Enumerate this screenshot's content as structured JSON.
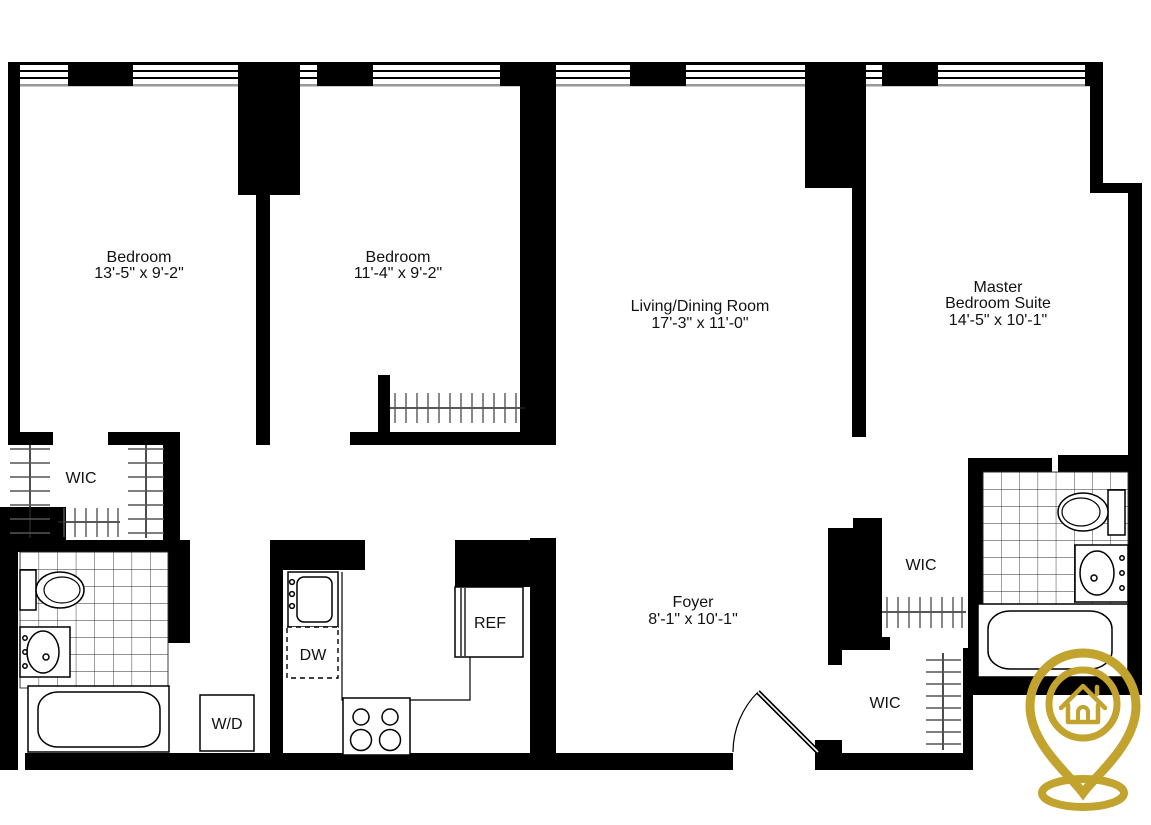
{
  "floorplan": {
    "rooms": {
      "bedroom1": {
        "name": "Bedroom",
        "dims": "13'-5\" x 9'-2\""
      },
      "bedroom2": {
        "name": "Bedroom",
        "dims": "11'-4\" x 9'-2\""
      },
      "living": {
        "name": "Living/Dining Room",
        "dims": "17'-3\" x 11'-0\""
      },
      "master": {
        "name_line1": "Master",
        "name_line2": "Bedroom Suite",
        "dims": "14'-5\" x 10'-1\""
      },
      "foyer": {
        "name": "Foyer",
        "dims": "8'-1\" x 10'-1\""
      }
    },
    "closets": {
      "wic_left": "WIC",
      "wic_master_upper": "WIC",
      "wic_master_lower": "WIC"
    },
    "appliances": {
      "dishwasher": "DW",
      "refrigerator": "REF",
      "washer_dryer": "W/D"
    },
    "logo": {
      "icon": "house-location-pin"
    },
    "colors": {
      "wall": "#000000",
      "logo_gold": "#c2a32e",
      "tile_line": "#2a2a2a",
      "hatch": "#555555",
      "window_sill": "#999999"
    }
  }
}
